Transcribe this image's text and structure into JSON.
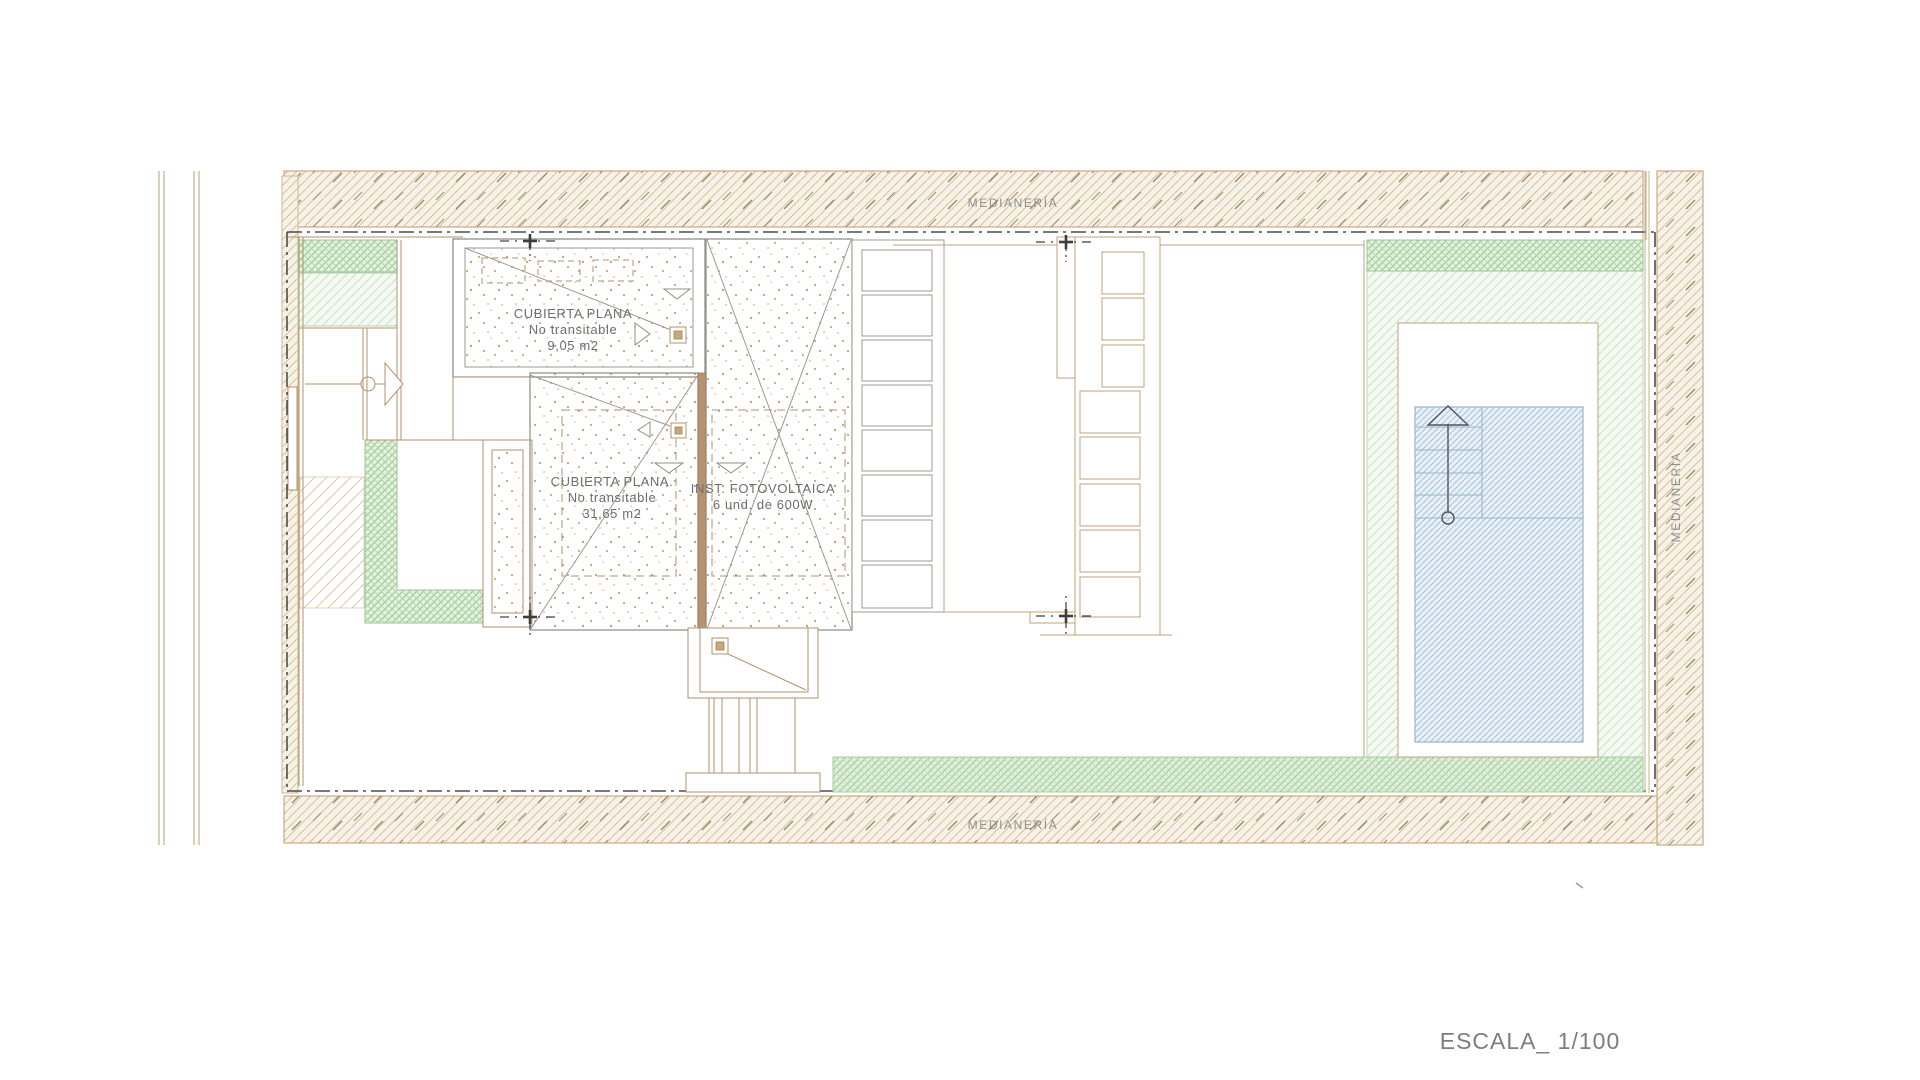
{
  "plan": {
    "labels": {
      "medianeria_top": "MEDIANERÍA",
      "medianeria_bottom": "MEDIANERÍA",
      "medianeria_right": "MEDIANERÍA",
      "scale": "ESCALA_ 1/100"
    },
    "annotations": {
      "roof_small": [
        "CUBIERTA PLANA",
        "No transitable",
        "9,05 m2"
      ],
      "roof_large": [
        "CUBIERTA PLANA.",
        "No transitable",
        "31,65 m2"
      ],
      "photovoltaic": [
        "INST. FOTOVOLTAICA",
        "6 und.  de 600W"
      ]
    },
    "colors": {
      "wall_tan": "#b4926e",
      "hatch_tan": "#d8c09c",
      "garden_green": "#96c690",
      "pool_blue": "#a9c3da",
      "boundary_dark": "#4d4d4d",
      "text_gray": "#6e6e6e"
    }
  }
}
